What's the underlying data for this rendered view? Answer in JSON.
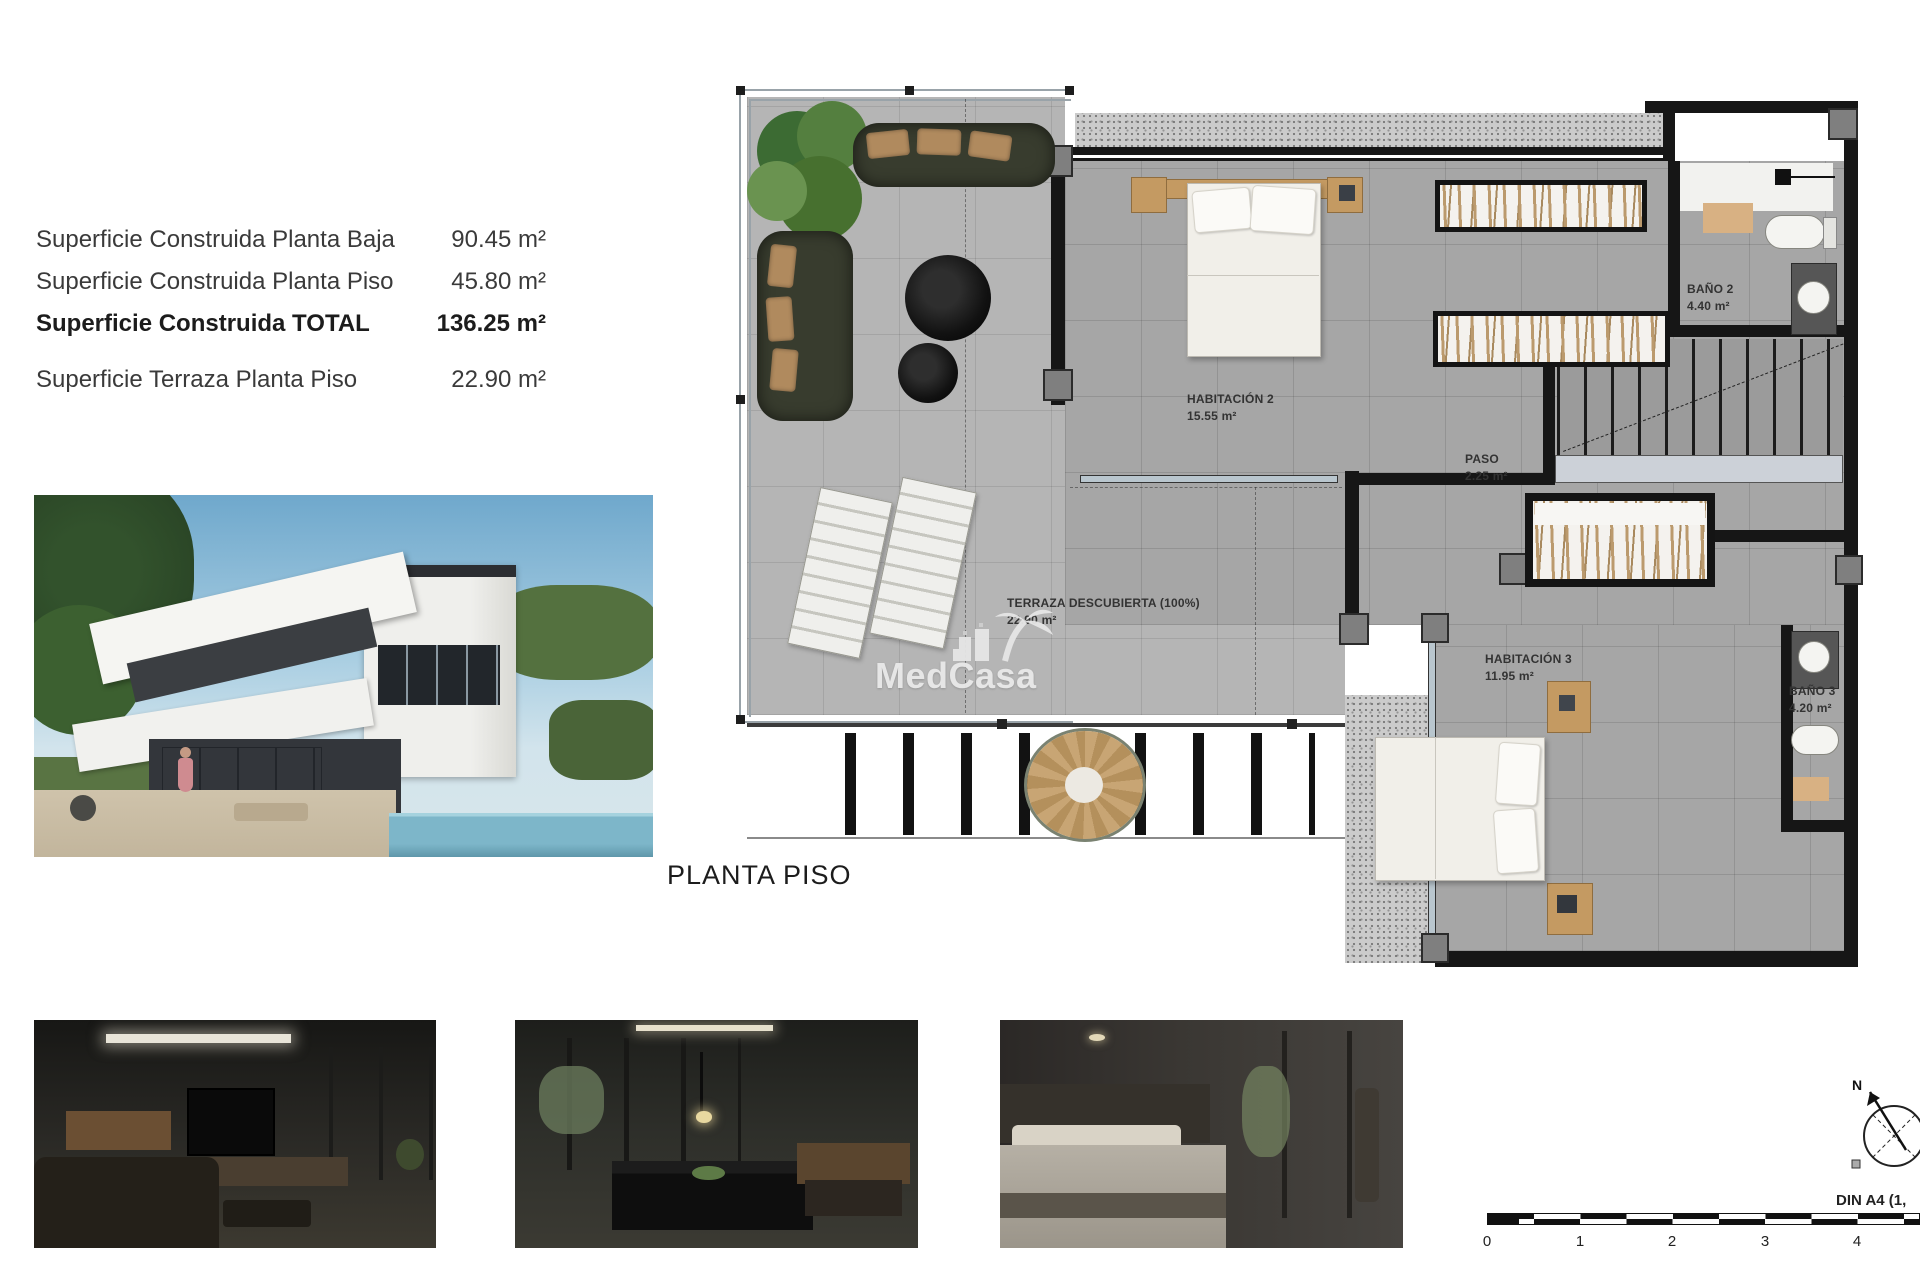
{
  "summary": {
    "rows": [
      {
        "label": "Superficie Construida Planta Baja",
        "value": "90.45 m²"
      },
      {
        "label": "Superficie Construida Planta Piso",
        "value": "45.80 m²"
      },
      {
        "label": "Superficie Construida TOTAL",
        "value": "136.25 m²"
      },
      {
        "label": "Superficie Terraza Planta Piso",
        "value": "22.90 m²"
      }
    ]
  },
  "plan": {
    "title": "PLANTA PISO",
    "watermark": "MedCasa",
    "rooms": [
      {
        "name": "HABITACIÓN 2",
        "area": "15.55 m²"
      },
      {
        "name": "BAÑO 2",
        "area": "4.40 m²"
      },
      {
        "name": "PASO",
        "area": "2.25 m²"
      },
      {
        "name": "HABITACIÓN 3",
        "area": "11.95 m²"
      },
      {
        "name": "BAÑO 3",
        "area": "4.20 m²"
      },
      {
        "name": "TERRAZA DESCUBIERTA (100%)",
        "area": "22.90 m²"
      }
    ]
  },
  "footer": {
    "din_label": "DIN A4 (1,",
    "compass_north": "N",
    "scale_ticks": [
      "0",
      "1",
      "2",
      "3",
      "4"
    ]
  },
  "colors": {
    "wall": "#161616",
    "interior_tile": "#a6a6a6",
    "terrace_tile": "#b5b5b5",
    "wood": "#c49a62",
    "pool": "#7db6c9",
    "watermark": "#e9e9e9"
  }
}
